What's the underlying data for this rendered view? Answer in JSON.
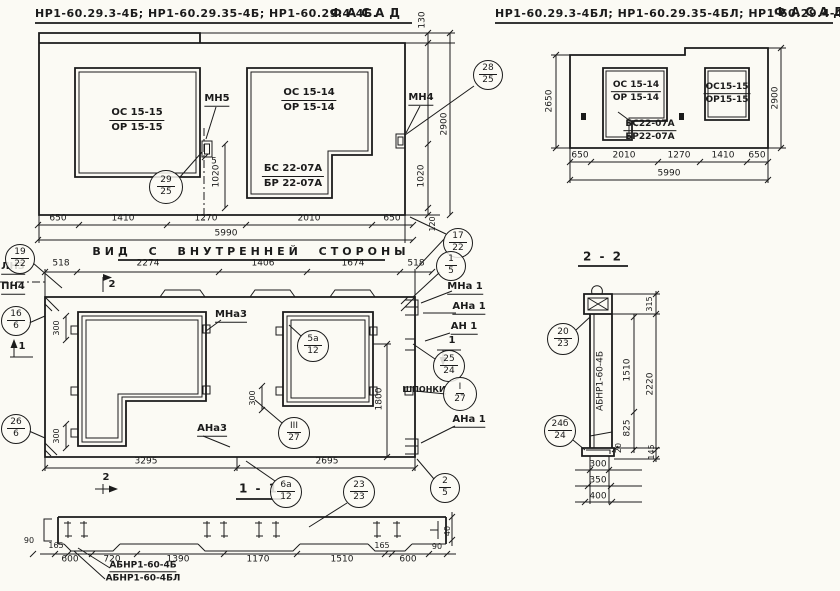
{
  "fl": {
    "title": "НР1-60.29.3-4Б; НР1-60.29.35-4Б; НР1-60.29.4-4Б.",
    "fasad": "ФАСАД",
    "w1a": "ОС 15-15",
    "w1b": "ОР 15-15",
    "w2a": "ОС 15-14",
    "w2b": "ОР 15-14",
    "sa": "БС 22-07А",
    "sb": "БР 22-07А",
    "mn5": "МН5",
    "mn4": "МН4",
    "d650a": "650",
    "d1410": "1410",
    "d1270": "1270",
    "d2010": "2010",
    "d650b": "650",
    "total": "5990",
    "d130": "130",
    "d2900": "2900",
    "d1020r": "1020",
    "d120": "120",
    "d1020": "1020",
    "d5": "5",
    "c29": {
      "a": "29",
      "b": "25"
    },
    "c28": {
      "a": "28",
      "b": "25"
    }
  },
  "fr": {
    "title": "НР1-60.29.3-4БЛ; НР1-60.29.35-4БЛ; НР1-60.29.4-4БЛ",
    "fasad": "ФАСАД",
    "w1a": "ОС 15-14",
    "w1b": "ОР 15-14",
    "sa": "БС22-07А",
    "sb": "БР22-07А",
    "w2a": "ОС15-15",
    "w2b": "ОР15-15",
    "d650a": "650",
    "d2010": "2010",
    "d1270": "1270",
    "d1410": "1410",
    "d650b": "650",
    "total": "5990",
    "d2650": "2650",
    "d2900": "2900"
  },
  "iv": {
    "title": "ВИД С ВНУТРЕННЕЙ СТОРОНЫ",
    "d518a": "518",
    "d2274": "2274",
    "d1406": "1406",
    "d1674": "1674",
    "d518b": "518",
    "ln3": "ЛН3",
    "pn4": "ПН4",
    "mna3": "МНа3",
    "mna1": "МНа 1",
    "ana1": "АНа 1",
    "an1": "АН 1",
    "ana1b": "АНа 1",
    "ana3": "АНа3",
    "shponki": "ШПОНКИ",
    "d300a": "300",
    "d300b": "300",
    "d300c": "300",
    "d1800": "1800",
    "d3295": "3295",
    "d2695": "2695",
    "s1": "1",
    "s1r": "1",
    "s2": "2",
    "s2b": "2",
    "c17": {
      "a": "17",
      "b": "22"
    },
    "c19": {
      "a": "19",
      "b": "22"
    },
    "c16": {
      "a": "16",
      "b": "6"
    },
    "c26": {
      "a": "26",
      "b": "6"
    },
    "c1": {
      "a": "1",
      "b": "5"
    },
    "c25": {
      "a": "25",
      "b": "24"
    },
    "cI": {
      "a": "I",
      "b": "27"
    },
    "cIII": {
      "a": "III",
      "b": "27"
    },
    "c5a": {
      "a": "5а",
      "b": "12"
    },
    "c2": {
      "a": "2",
      "b": "5"
    }
  },
  "s22": {
    "title": "2 - 2",
    "part": "АБНР1-60-4Б",
    "d315": "315",
    "d1510": "1510",
    "d2220": "2220",
    "d825": "825",
    "d20": "20",
    "d145": "145",
    "d300": "300",
    "d350": "350",
    "d400": "400",
    "c20": {
      "a": "20",
      "b": "23"
    },
    "c24": {
      "a": "24б",
      "b": "24"
    }
  },
  "s11": {
    "title": "1 - 1",
    "part1": "АБНР1-60-4Б",
    "part2": "АБНР1-60-4БЛ",
    "d90l": "90",
    "d165l": "165",
    "d600l": "600",
    "d720": "720",
    "d1390": "1390",
    "d1170": "1170",
    "d1510": "1510",
    "d600r": "600",
    "d165r": "165",
    "d90r": "90",
    "d40": "40",
    "c6a": {
      "a": "6а",
      "b": "12"
    },
    "c23": {
      "a": "23",
      "b": "23"
    }
  }
}
